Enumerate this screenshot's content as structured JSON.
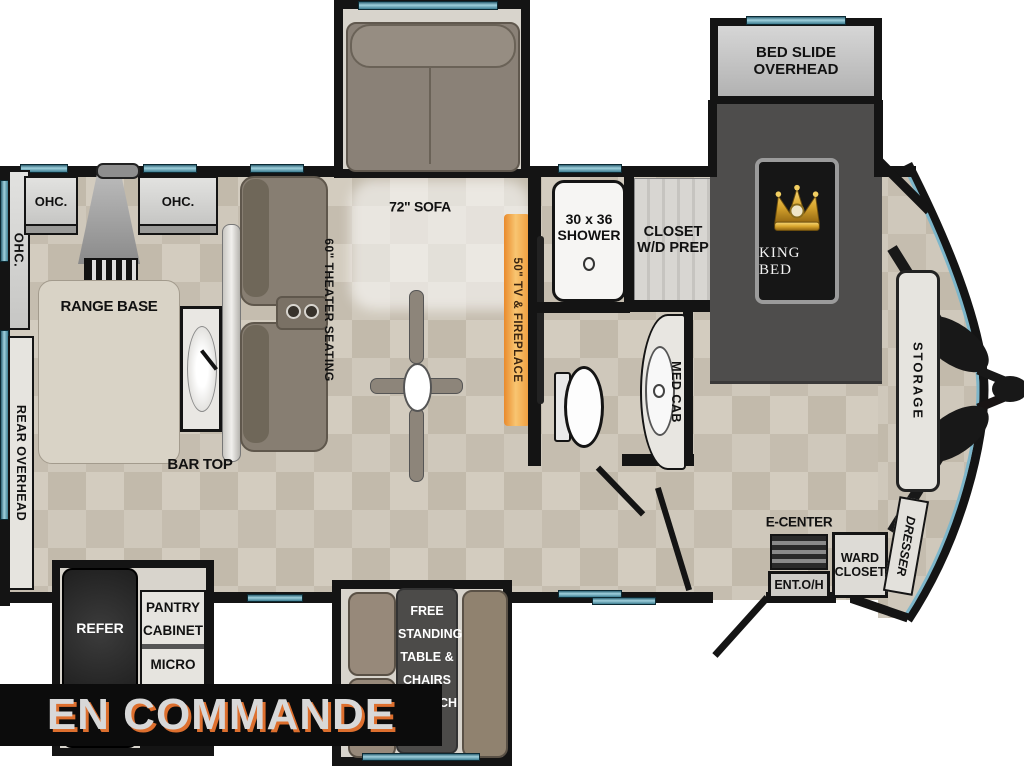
{
  "banner": {
    "text": "EN COMMANDE"
  },
  "bedroom": {
    "bed_slide_line1": "BED SLIDE",
    "bed_slide_line2": "OVERHEAD",
    "bed": "KING BED"
  },
  "living": {
    "sofa": "72\" SOFA",
    "theater": "60\" THEATER SEATING",
    "tv_fireplace": "50\" TV & FIREPLACE"
  },
  "kitchen": {
    "ohc_vertical": "OHC.",
    "ohc_left": "OHC.",
    "ohc_right": "OHC.",
    "range_base": "RANGE BASE",
    "rear_overhead": "REAR OVERHEAD",
    "bar_top": "BAR TOP",
    "refer": "REFER",
    "pantry_line1": "PANTRY",
    "pantry_line2": "CABINET",
    "micro": "MICRO"
  },
  "dinette": {
    "line1": "FREE",
    "line2": "STANDING",
    "line3": "TABLE &",
    "line4": "CHAIRS",
    "line5": "W/HUTCH"
  },
  "bath": {
    "shower_line1": "30 x 36",
    "shower_line2": "SHOWER",
    "closet_line1": "CLOSET",
    "closet_line2": "W/D PREP",
    "med_cab": "MED CAB"
  },
  "front": {
    "storage": "STORAGE",
    "dresser": "DRESSER",
    "e_center": "E-CENTER",
    "ent_oh": "ENT.O/H",
    "ward_line1": "WARD",
    "ward_line2": "CLOSET"
  },
  "colors": {
    "banner_bg": "#0c0c0c",
    "banner_text": "#d8d8d8",
    "banner_shadow": "#dd6f2e",
    "window_teal": "#7db6ca",
    "fireplace_orange": "#f09a3c",
    "crown_gold": "#d9a62e",
    "wall_black": "#141414",
    "floor_beige": "#cfc8bb",
    "bed_slide_gray": "#4e4d4c"
  }
}
